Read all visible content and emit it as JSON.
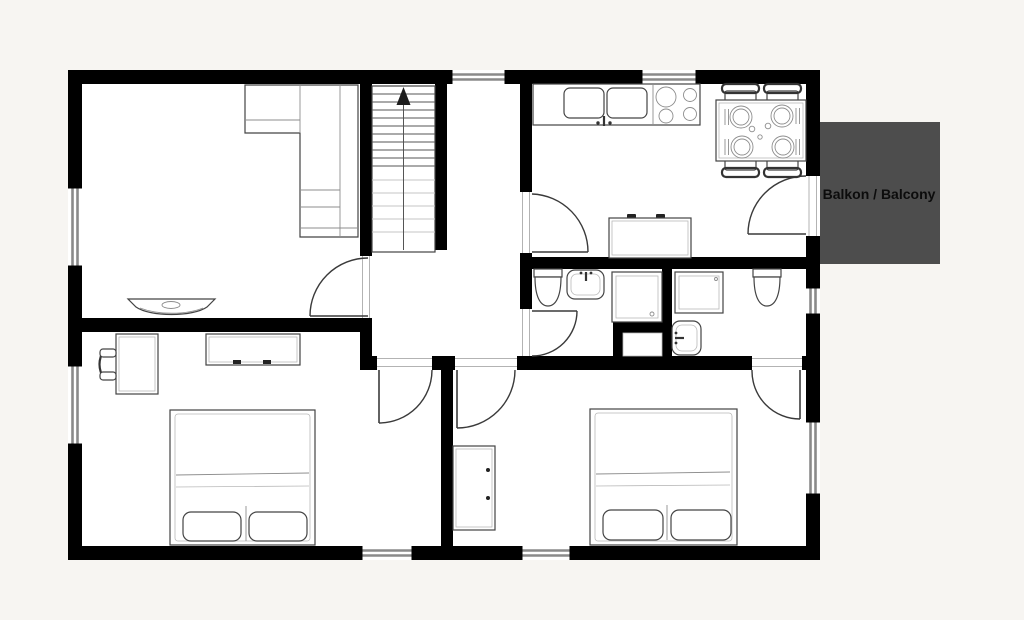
{
  "labels": {
    "balcony": "Balkon / Balcony"
  },
  "colors": {
    "background": "#f7f5f2",
    "floor": "#ffffff",
    "wall": "#000000",
    "balcony_fill": "#4d4d4d",
    "balcony_text": "#0c0c0c",
    "furniture_stroke": "#444444",
    "window_glass": "#8a8a8a"
  },
  "plan": {
    "type": "apartment-floor-plan",
    "fixtures": [
      "l-shaped-sofa",
      "wall-tv-console",
      "staircase-up-arrow",
      "desk-with-chair",
      "sideboard",
      "double-bed-with-two-pillows",
      "double-bed-with-two-pillows",
      "wardrobe",
      "kitchen-counter-double-sink",
      "stove-four-burners",
      "dining-table-four-chairs-four-plates",
      "kitchen-sideboard",
      "toilet",
      "toilet",
      "washbasin",
      "washbasin",
      "shower-cabin",
      "shower-tray",
      "service-duct",
      "door-swing",
      "window"
    ]
  }
}
